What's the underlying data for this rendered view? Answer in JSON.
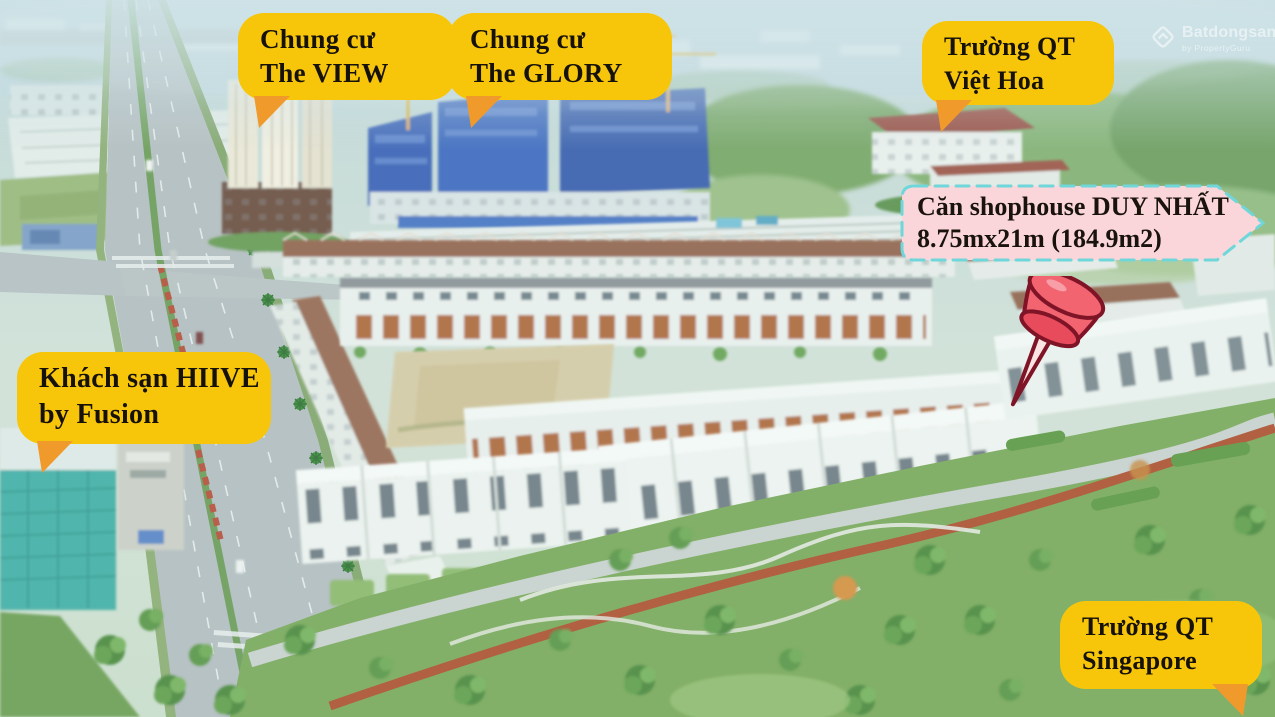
{
  "callouts": {
    "the_view": {
      "line1": "Chung cư",
      "line2": "The VIEW"
    },
    "the_glory": {
      "line1": "Chung cư",
      "line2": "The GLORY"
    },
    "viet_hoa": {
      "line1": "Trường QT",
      "line2": "Việt Hoa"
    },
    "hiive": {
      "line1": "Khách sạn HIIVE",
      "line2": "by Fusion"
    },
    "singapore": {
      "line1": "Trường QT",
      "line2": "Singapore"
    },
    "shophouse": {
      "line1": "Căn shophouse DUY NHẤT",
      "line2": "8.75mx21m (184.9m2)"
    }
  },
  "watermark": {
    "brand": "Batdongsan",
    "suffix": "com.vn",
    "tagline": "by PropertyGuru"
  },
  "colors": {
    "label_background": "#F7C60A",
    "label_tail": "#F09A2B",
    "label_text": "#16120A",
    "highlight_background": "#FAD6DB",
    "highlight_border": "#6FD6DA",
    "pushpin_red": "#F16470",
    "pushpin_dark": "#7E1426"
  }
}
